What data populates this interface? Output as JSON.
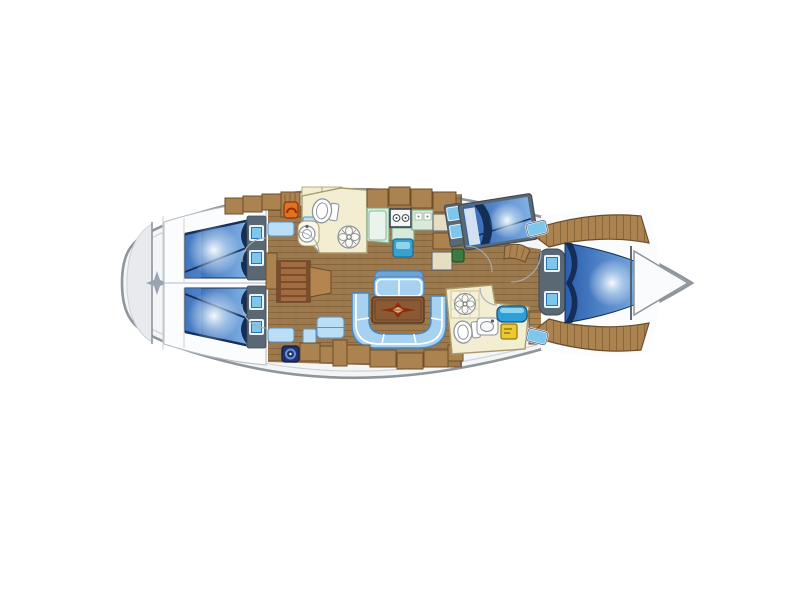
{
  "diagram": {
    "type": "sailing-yacht-interior-floor-plan",
    "label": "Sailing yacht interior layout, bow pointing right",
    "orientation": "bow-right",
    "regions": [
      {
        "id": "stern-platform",
        "label": "stern swim platform"
      },
      {
        "id": "aft-cabin-top",
        "label": "aft double cabin (top)"
      },
      {
        "id": "aft-cabin-bottom",
        "label": "aft double cabin (bottom)"
      },
      {
        "id": "companionway",
        "label": "companionway steps"
      },
      {
        "id": "aft-head",
        "label": "aft head with toilet, sink and shower fan"
      },
      {
        "id": "galley",
        "label": "galley with stove, fridge and sink"
      },
      {
        "id": "nav-station",
        "label": "navigation station"
      },
      {
        "id": "salon",
        "label": "salon with U-settee, bench and table with compass rose"
      },
      {
        "id": "forward-cabin-angled-berth",
        "label": "forward cabin angled double berth"
      },
      {
        "id": "forward-head",
        "label": "forward head with shower, toilet and sink"
      },
      {
        "id": "v-berth-cabin",
        "label": "bow V-berth cabin"
      },
      {
        "id": "anchor-locker",
        "label": "anchor locker at bow"
      }
    ]
  },
  "palette": {
    "bg": "#ffffff",
    "hull_fill": "#f4f5f7",
    "hull_stroke": "#8e959b",
    "inner_line": "#cdd2d7",
    "platform": "#e8eaee",
    "star": "#9aa4b0",
    "room_white": "#fbfcfe",
    "room_edge": "#b3bac1",
    "wood": "#9c7a4e",
    "wood_line": "#85643c",
    "locker": "#aa8350",
    "locker_dark": "#6d4c28",
    "steps": "#a26b40",
    "steps_dark": "#5f3c22",
    "landing": "#b5854f",
    "berth_deep": "#2a5fae",
    "berth_mid": "#7fb0e4",
    "berth_navy": "#142e57",
    "slate": "#5a6874",
    "slate_dark": "#3e4a54",
    "hatch_sky": "#7ec6ec",
    "hatch_deep": "#2f6fb4",
    "hatch_frame": "#eaf4fc",
    "shelf_blue": "#b9def5",
    "shelf_edge": "#5e94c4",
    "sofa": "#a6d1f0",
    "sofa_edge": "#4a86be",
    "bench_back": "#6aa6d8",
    "trim_white": "#ffffff",
    "table": "#8a5a35",
    "table_edge": "#5c3a20",
    "rose": "#8a2d10",
    "rose_light": "#e0b277",
    "cream": "#f3edd2",
    "cream_edge": "#a89a6a",
    "fixture": "#8e959b",
    "fixture_dark": "#5a5f66",
    "green": "#d9eadb",
    "green_edge": "#74a887",
    "green_light": "#eaf4ec",
    "teal": "#38a2cd",
    "teal_dark": "#1f6e93",
    "teal_light": "#8fd4ef",
    "orange": "#e0731d",
    "orange_dark": "#942f0c",
    "yellow": "#ecc832",
    "yellow_dark": "#8f7a10",
    "navy_item": "#20336f",
    "navy_item_light": "#6c8fd8",
    "green_box": "#3c7a44",
    "blue_seat": "#2f9fd8",
    "wall": "#4e5a64",
    "arc": "#a7adb4",
    "tan_box": "#e7ddc0"
  }
}
